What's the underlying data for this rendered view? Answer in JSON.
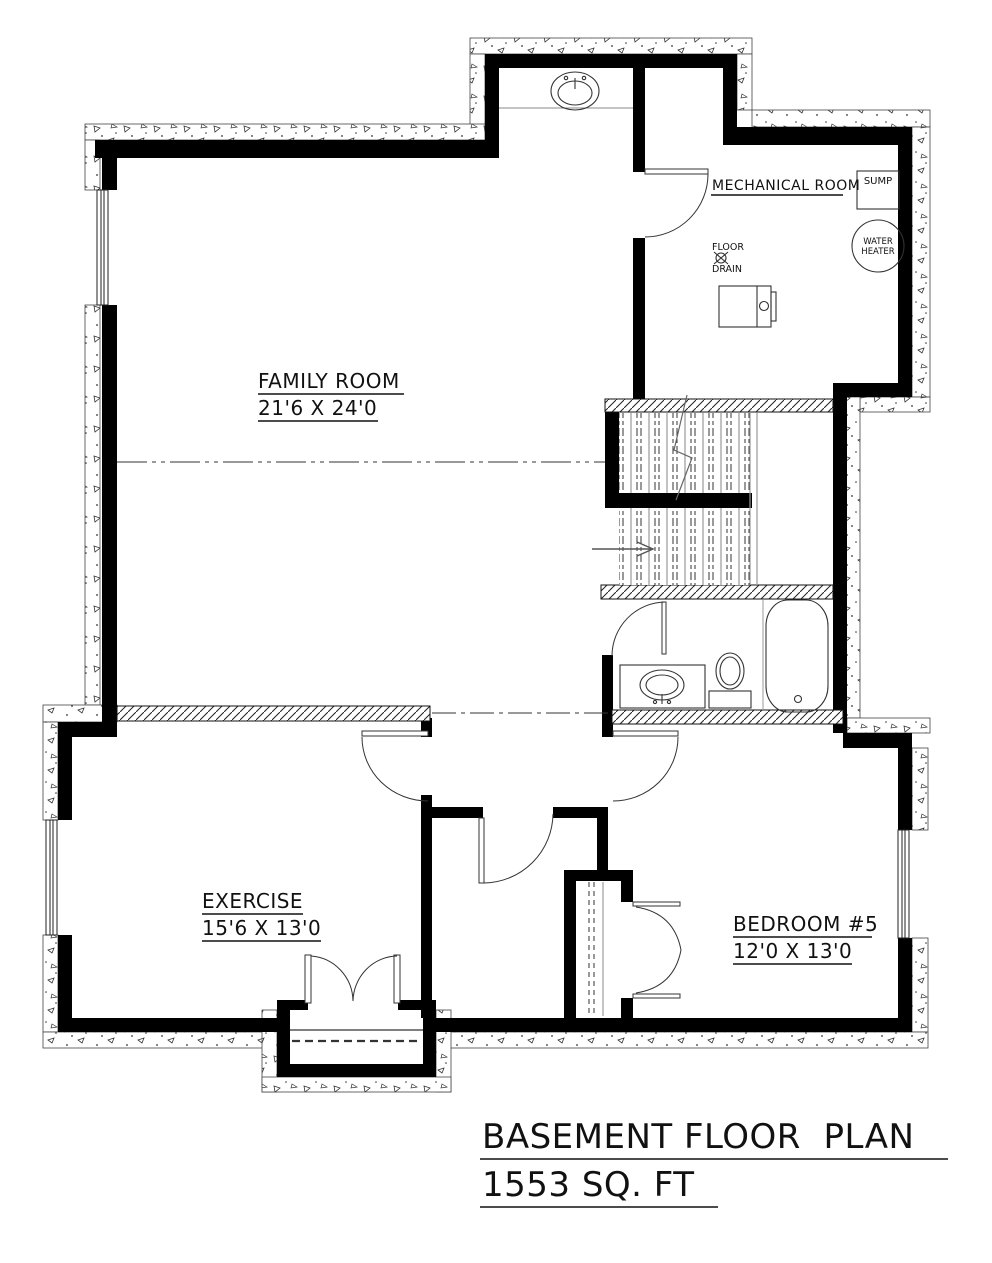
{
  "plan": {
    "rooms": {
      "family_room": {
        "name": "FAMILY ROOM",
        "dims": "21'6 X 24'0"
      },
      "mechanical_room": {
        "name": "MECHANICAL ROOM"
      },
      "exercise": {
        "name": "EXERCISE",
        "dims": "15'6 X 13'0"
      },
      "bedroom5": {
        "name": "BEDROOM #5",
        "dims": "12'0 X 13'0"
      }
    },
    "fixtures": {
      "sump": {
        "label": "SUMP"
      },
      "water_heater": {
        "label_line1": "WATER",
        "label_line2": "HEATER"
      },
      "floor_drain": {
        "label_line1": "FLOOR",
        "label_line2": "DRAIN"
      }
    },
    "title": {
      "line1": "BASEMENT FLOOR  PLAN",
      "line2": "1553 SQ. FT"
    },
    "colors": {
      "wall": "#000000",
      "hatch": "#333333",
      "gray_line": "#888888",
      "background": "#ffffff"
    }
  }
}
